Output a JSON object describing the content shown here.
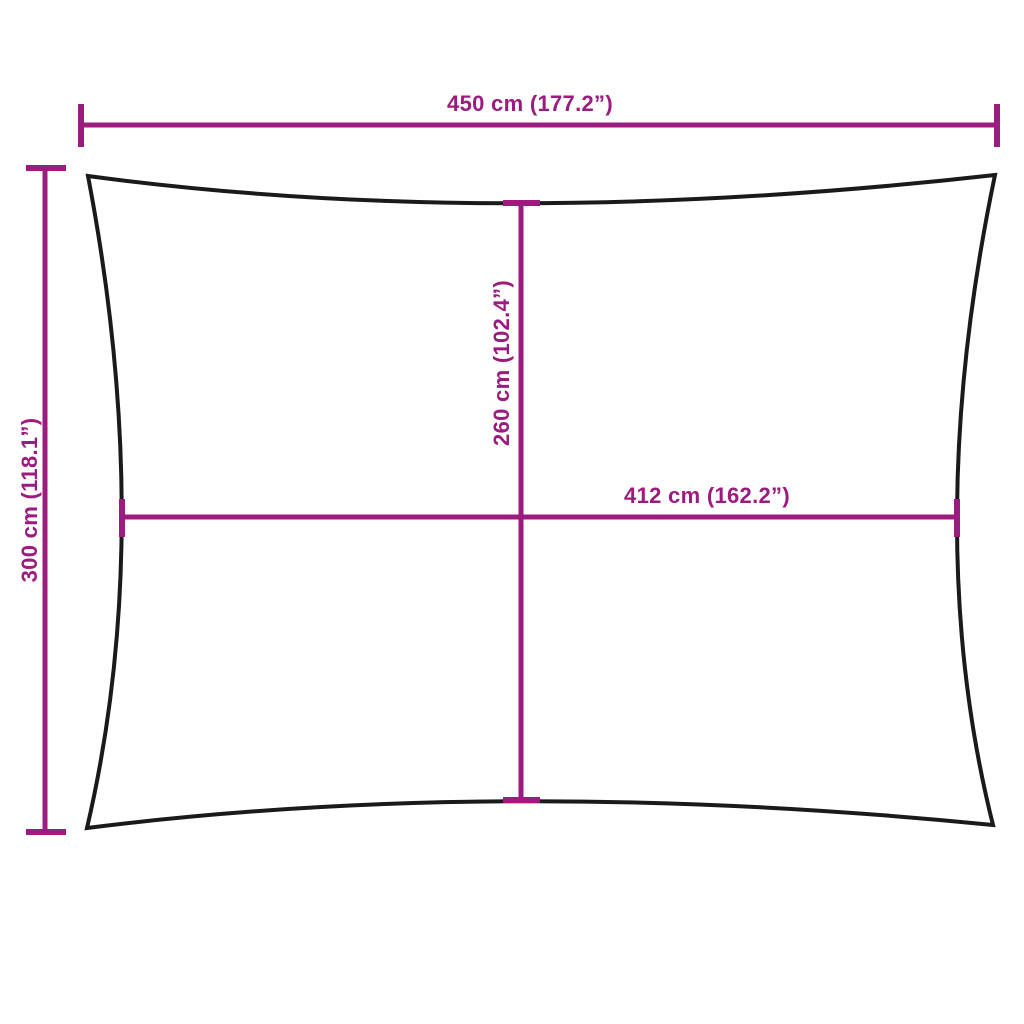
{
  "diagram": {
    "title": "shade-sail-dimension-diagram",
    "dimensions": {
      "top_width": {
        "cm": 450,
        "inches": 177.2,
        "label": "450 cm (177.2”)"
      },
      "left_height": {
        "cm": 300,
        "inches": 118.1,
        "label": "300 cm (118.1”)"
      },
      "inner_height": {
        "cm": 260,
        "inches": 102.4,
        "label": "260 cm (102.4”)"
      },
      "inner_width": {
        "cm": 412,
        "inches": 162.2,
        "label": "412 cm (162.2”)"
      }
    },
    "colors": {
      "dimension_accent": "#9b1b7e",
      "outline": "#1a1a1a",
      "background": "#ffffff"
    }
  }
}
